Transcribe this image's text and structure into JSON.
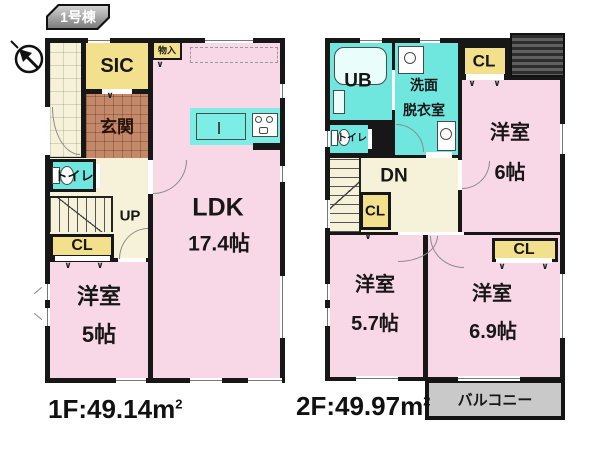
{
  "building_tag": "1号棟",
  "compass": {
    "icon": "north-arrow"
  },
  "floor1": {
    "rooms": {
      "sic": "SIC",
      "genkan": "玄関",
      "toilet": "トイレ",
      "storage": "物入",
      "stairs": "UP",
      "closet": "CL",
      "western_room": "洋室",
      "western_room_size": "5帖",
      "ldk": "LDK",
      "ldk_size": "17.4帖"
    },
    "area_label": "1F:49.14m",
    "area_sup": "2"
  },
  "floor2": {
    "rooms": {
      "unit_bath": "UB",
      "washroom_line1": "洗面",
      "washroom_line2": "脱衣室",
      "closet_top": "CL",
      "western_room_6": "洋室",
      "western_room_6_size": "6帖",
      "toilet": "トイレ",
      "stairs": "DN",
      "closet_mid": "CL",
      "western_room_57": "洋室",
      "western_room_57_size": "5.7帖",
      "western_room_69": "洋室",
      "western_room_69_size": "6.9帖",
      "closet_bottom": "CL",
      "balcony": "バルコニー"
    },
    "area_label": "2F:49.97m",
    "area_sup": "2"
  },
  "decor": {
    "hanger_mark": "∨"
  },
  "colors": {
    "wall": "#171717",
    "room_pink": "#f8d7e7",
    "water_cyan": "#6fe6de",
    "closet_yellow": "#f3e08c",
    "hall_cream": "#f6f2d9",
    "genkan_brown": "#c3896a",
    "balcony_gray": "#c9c9c9"
  }
}
